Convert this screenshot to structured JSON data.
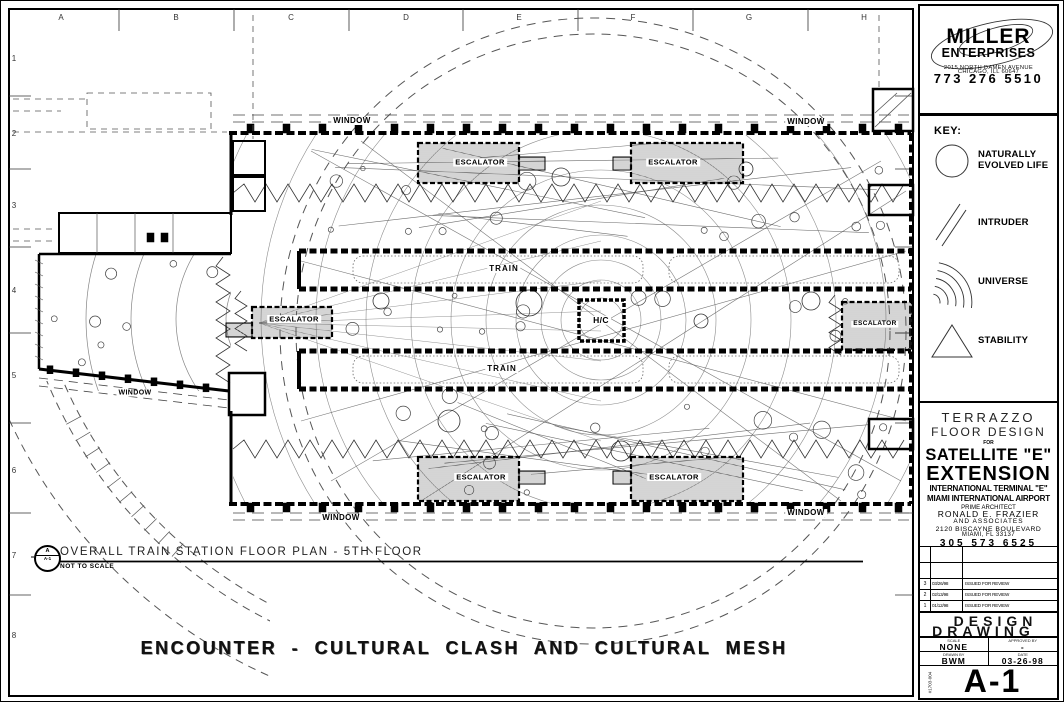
{
  "grid": {
    "columns": [
      "A",
      "B",
      "C",
      "D",
      "E",
      "F",
      "G",
      "H"
    ],
    "rows": [
      "1",
      "2",
      "3",
      "4",
      "5",
      "6",
      "7",
      "8"
    ]
  },
  "plan": {
    "labels": {
      "window": "WINDOW",
      "train": "TRAIN",
      "escalator": "ESCALATOR",
      "hc": "H/C"
    }
  },
  "caption": {
    "bubble_top": "A",
    "bubble_bottom": "A-1",
    "title": "OVERALL TRAIN STATION FLOOR PLAN  - 5TH FLOOR",
    "scale_note": "NOT TO SCALE"
  },
  "footer_title": "ENCOUNTER  -  CULTURAL CLASH AND CULTURAL MESH",
  "titleblock": {
    "company": {
      "name_line1": "MILLER",
      "name_line2": "ENTERPRISES",
      "address_line1": "2015 NORTH DAMEN AVENUE",
      "address_line2": "CHICAGO, ILL 60647",
      "phone": "773 276 5510"
    },
    "key": {
      "title": "KEY:",
      "items": [
        {
          "symbol": "circle-icon",
          "label": "NATURALLY EVOLVED LIFE"
        },
        {
          "symbol": "diagonal-lines-icon",
          "label": "INTRUDER"
        },
        {
          "symbol": "radiating-arcs-icon",
          "label": "UNIVERSE"
        },
        {
          "symbol": "triangle-icon",
          "label": "STABILITY"
        }
      ]
    },
    "project": {
      "subject_line1": "TERRAZZO",
      "subject_line2": "FLOOR DESIGN",
      "for_word": "FOR",
      "title_line1": "SATELLITE \"E\"",
      "title_line2": "EXTENSION",
      "subtitle_line1": "INTERNATIONAL TERMINAL \"E\"",
      "subtitle_line2": "MIAMI INTERNATIONAL AIRPORT",
      "architect_role": "PRIME ARCHITECT",
      "architect_name": "RONALD E. FRAZIER",
      "architect_assoc": "AND ASSOCIATES",
      "architect_address1": "2120 BISCAYNE BOULEVARD",
      "architect_address2": "MIAMI, FL 33137",
      "architect_phone": "305 573 6525"
    },
    "revisions": [
      {
        "num": "3",
        "date": "03/26/98",
        "desc": "ISSUED FOR REVIEW"
      },
      {
        "num": "2",
        "date": "02/13/98",
        "desc": "ISSUED FOR REVIEW"
      },
      {
        "num": "1",
        "date": "01/12/98",
        "desc": "ISSUED FOR REVIEW"
      }
    ],
    "drawing_type_line1": "DESIGN",
    "drawing_type_line2": "DRAWING",
    "info": {
      "scale_label": "SCALE",
      "scale_value": "NONE",
      "approved_label": "APPROVED BY",
      "approved_value": "-",
      "drawn_label": "DRAWN BY",
      "drawn_value": "BWM",
      "date_label": "DATE",
      "date_value": "03-26-98"
    },
    "sheet_number": "A-1",
    "job_number": "#1703-004"
  }
}
